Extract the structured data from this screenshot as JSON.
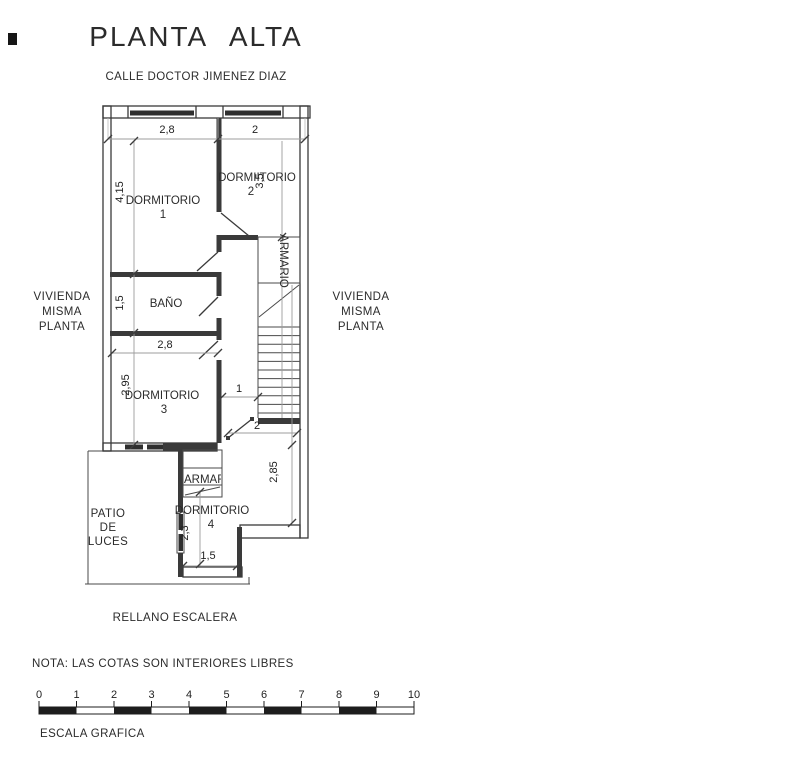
{
  "title": "PLANTA ALTA",
  "street": "CALLE DOCTOR JIMENEZ DIAZ",
  "neighbors": {
    "left": [
      "VIVIENDA",
      "MISMA",
      "PLANTA"
    ],
    "right": [
      "VIVIENDA",
      "MISMA",
      "PLANTA"
    ]
  },
  "rooms": {
    "dormitorio1": {
      "name": "DORMITORIO",
      "number": "1"
    },
    "dormitorio2": {
      "name": "DORMIITORIO",
      "number": "2"
    },
    "bano": {
      "name": "BAÑO"
    },
    "dormitorio3": {
      "name": "DORMITORIO",
      "number": "3"
    },
    "dormitorio4": {
      "name": "DORMITORIO",
      "number": "4"
    },
    "armario_stair": "ARMARIO",
    "armario_upper": "ARMARIO",
    "armario_lower": "ARMARIO",
    "patio": [
      "PATIO",
      "DE",
      "LUCES"
    ],
    "rellano": "RELLANO ESCALERA"
  },
  "dimensions": {
    "dorm1_width": "2,8",
    "dorm2_width": "2",
    "dorm1_height": "4,15",
    "dorm2_height": "3,5",
    "bano_height": "1,5",
    "dorm3_width": "2,8",
    "dorm3_height": "2,95",
    "hall_width": "1",
    "landing_width": "2",
    "dorm4_height": "2,85",
    "patio_window_height": "2,3",
    "dorm4_width": "1,5"
  },
  "note": "NOTA: LAS COTAS SON INTERIORES LIBRES",
  "scale_bar": {
    "labels": [
      "0",
      "1",
      "2",
      "3",
      "4",
      "5",
      "6",
      "7",
      "8",
      "9",
      "10"
    ],
    "caption": "ESCALA GRAFICA"
  },
  "colors": {
    "ink": "#2b2b2b",
    "wall": "#3a3a3a",
    "dim_line": "#9c9c9c",
    "paper": "#ffffff"
  }
}
